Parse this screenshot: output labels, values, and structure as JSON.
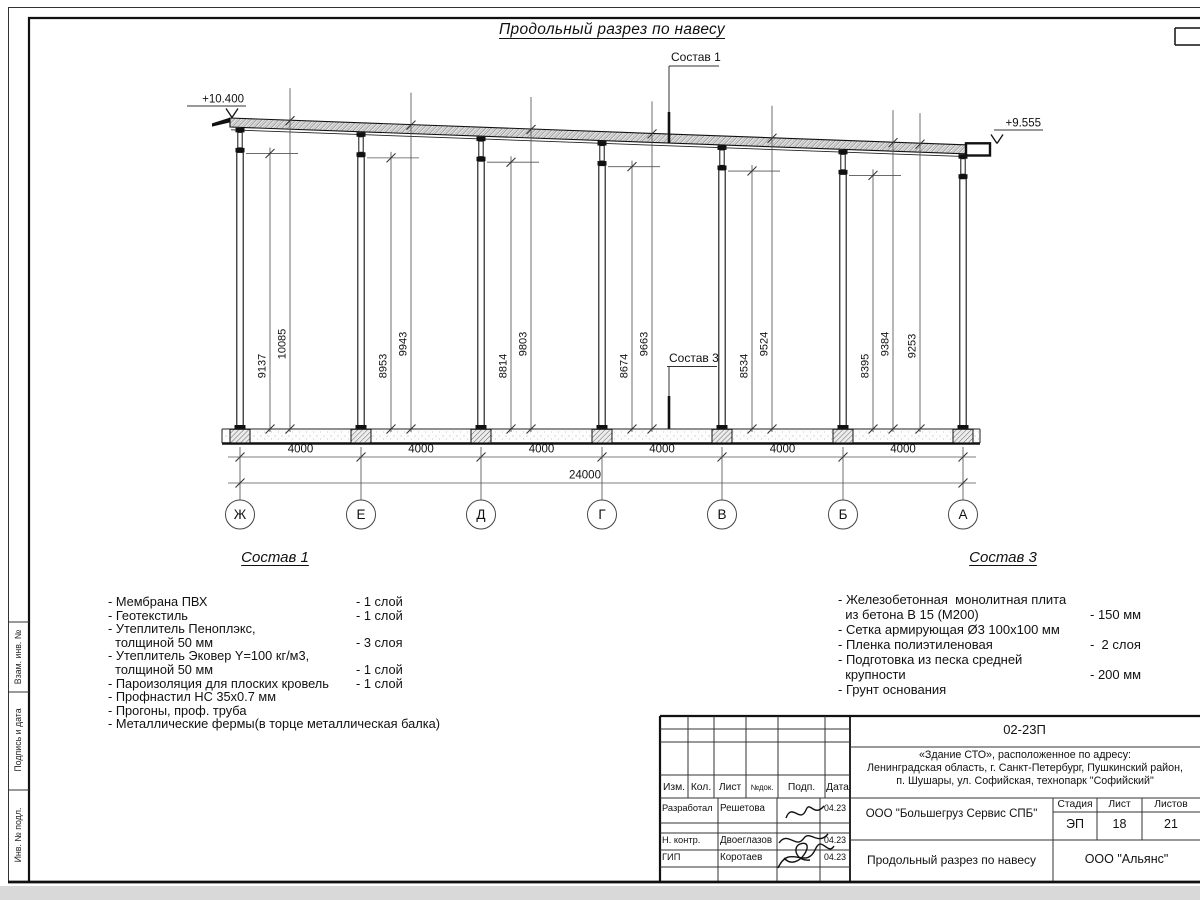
{
  "page_title": "Продольный разрез по навесу",
  "drawing": {
    "elevation_left": "+10.400",
    "elevation_right": "+9.555",
    "leader_label_roof": "Состав 1",
    "leader_label_slab": "Состав 3",
    "axes": [
      "Ж",
      "Е",
      "Д",
      "Г",
      "В",
      "Б",
      "А"
    ],
    "bay_labels": [
      "4000",
      "4000",
      "4000",
      "4000",
      "4000",
      "4000"
    ],
    "total_label": "24000",
    "column_dims": [
      {
        "inner": "9137",
        "outer": "10085"
      },
      {
        "inner": "8953",
        "outer": "9943"
      },
      {
        "inner": "8814",
        "outer": "9803"
      },
      {
        "inner": "8674",
        "outer": "9663"
      },
      {
        "inner": "8534",
        "outer": "9524"
      },
      {
        "inner": "8395",
        "outer": "9384",
        "extra": "9253"
      }
    ]
  },
  "composition1": {
    "title": "Состав 1",
    "items": [
      {
        "lines": [
          "- Мембрана ПВХ"
        ],
        "qty": "- 1 слой"
      },
      {
        "lines": [
          "- Геотекстиль"
        ],
        "qty": "- 1 слой"
      },
      {
        "lines": [
          "- Утеплитель Пеноплэкс,",
          "  толщиной 50 мм"
        ],
        "qty": "- 3 слоя"
      },
      {
        "lines": [
          "- Утеплитель Эковер Y=100 кг/м3,",
          "  толщиной 50 мм"
        ],
        "qty": "- 1 слой"
      },
      {
        "lines": [
          "- Пароизоляция для плоских кровель"
        ],
        "qty": "- 1 слой"
      },
      {
        "lines": [
          "- Профнастил НС 35х0.7 мм"
        ],
        "qty": ""
      },
      {
        "lines": [
          "- Прогоны, проф. труба"
        ],
        "qty": ""
      },
      {
        "lines": [
          "- Металлические фермы(в торце металлическая балка)"
        ],
        "qty": ""
      }
    ]
  },
  "composition3": {
    "title": "Состав 3",
    "items": [
      {
        "lines": [
          "- Железобетонная  монолитная плита",
          "  из бетона В 15 (М200)"
        ],
        "qty": "- 150 мм"
      },
      {
        "lines": [
          "- Сетка армирующая Ø3 100х100 мм"
        ],
        "qty": ""
      },
      {
        "lines": [
          "- Пленка полиэтиленовая"
        ],
        "qty": "-  2 слоя"
      },
      {
        "lines": [
          "- Подготовка из песка средней",
          "  крупности"
        ],
        "qty": "- 200 мм"
      },
      {
        "lines": [
          "- Грунт основания"
        ],
        "qty": ""
      }
    ]
  },
  "margin_labels": [
    "Взам. инв. №",
    "Подпись и дата",
    "Инв. № подл."
  ],
  "stamp": {
    "doc_code": "02-23П",
    "object_lines": [
      "«Здание СТО», расположенное по адресу:",
      "Ленинградская область, г. Санкт-Петербург, Пушкинский район,",
      "п. Шушары, ул. Софийская, технопарк \"Софийский\""
    ],
    "columns": [
      "Изм.",
      "Кол.",
      "Лист",
      "№док.",
      "Подп.",
      "Дата"
    ],
    "rows": [
      {
        "role": "Разработал",
        "name": "Решетова",
        "date": "04.23"
      },
      {
        "role": "Н. контр.",
        "name": "Двоеглазов",
        "date": "04.23"
      },
      {
        "role": "ГИП",
        "name": "Коротаев",
        "date": "04.23"
      }
    ],
    "company": "ООО \"Большегруз Сервис СПБ\"",
    "stage_label": "Стадия",
    "sheet_label": "Лист",
    "sheets_label": "Листов",
    "stage": "ЭП",
    "sheet_no": "18",
    "sheets_total": "21",
    "drawing_name": "Продольный разрез по навесу",
    "org": "ООО \"Альянс\""
  }
}
